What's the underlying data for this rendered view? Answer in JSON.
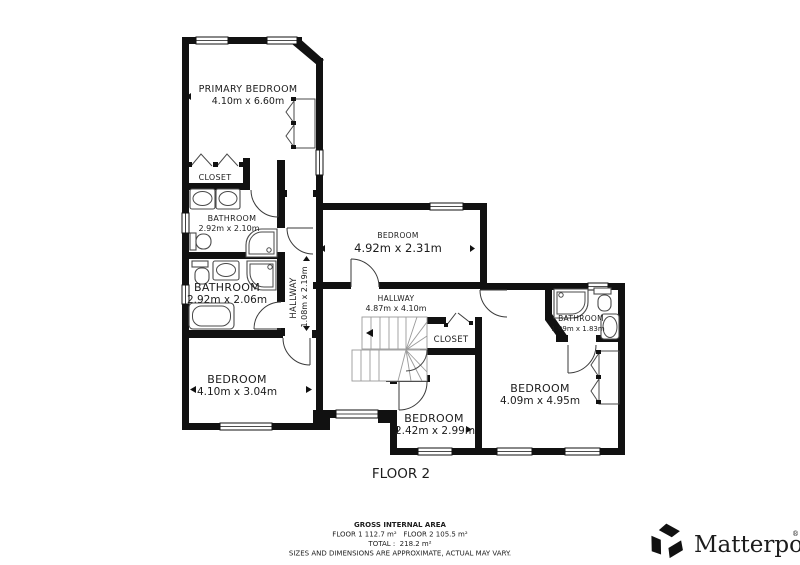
{
  "floor_title": "FLOOR 2",
  "rooms": {
    "primary_bedroom": {
      "name": "PRIMARY BEDROOM",
      "dims": "4.10m x 6.60m"
    },
    "closet_upper": {
      "name": "CLOSET"
    },
    "bathroom_upper": {
      "name": "BATHROOM",
      "dims": "2.92m x 2.10m"
    },
    "bathroom_mid": {
      "name": "BATHROOM",
      "dims": "2.92m x 2.06m"
    },
    "hallway_small": {
      "name": "HALLWAY",
      "dims": "1.08m x 2.19m"
    },
    "bedroom_mid": {
      "name": "BEDROOM",
      "dims": "4.92m x 2.31m"
    },
    "hallway_main": {
      "name": "HALLWAY",
      "dims": "4.87m x 4.10m"
    },
    "closet_center": {
      "name": "CLOSET"
    },
    "bedroom_left": {
      "name": "BEDROOM",
      "dims": "4.10m x 3.04m"
    },
    "bedroom_small": {
      "name": "BEDROOM",
      "dims": "2.42m x 2.99m"
    },
    "bedroom_right": {
      "name": "BEDROOM",
      "dims": "4.09m x 4.95m"
    },
    "bathroom_small": {
      "name": "BATHROOM",
      "dims": "1.99m x 1.83m"
    }
  },
  "footer": {
    "gross_label": "GROSS INTERNAL AREA",
    "floors_line": "FLOOR 1 112.7 m²   FLOOR 2 105.5 m²",
    "total_line": "TOTAL :  218.2 m²",
    "disclaimer": "SIZES AND DIMENSIONS ARE APPROXIMATE, ACTUAL MAY VARY."
  },
  "branding": {
    "logo_text": "Matterport",
    "registered_mark": "®"
  },
  "colors": {
    "wall": "#111111",
    "text": "#1c1c1c",
    "fixture": "#4a4a4a",
    "muted": "#8c8c8c"
  }
}
